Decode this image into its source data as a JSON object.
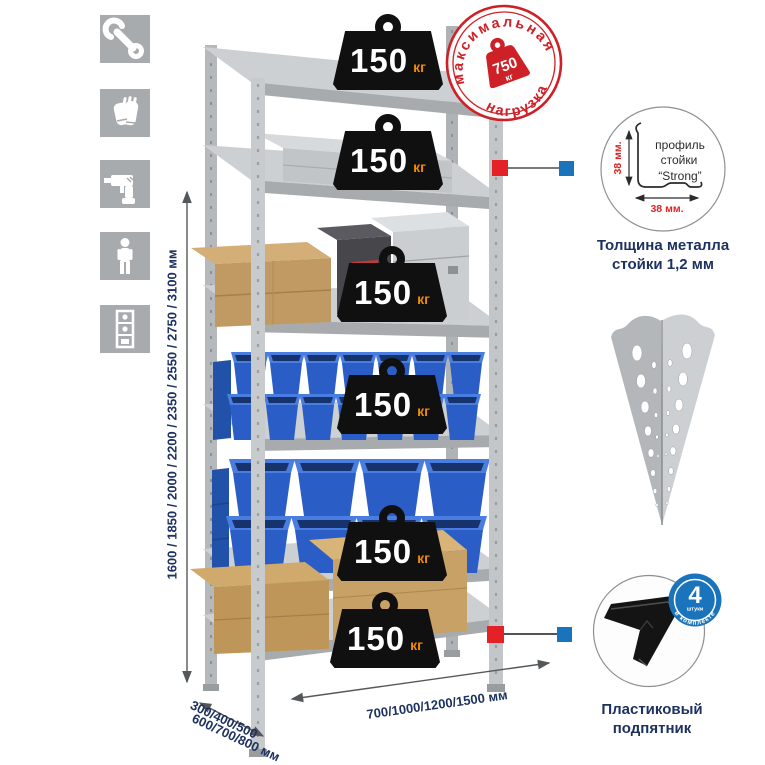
{
  "stamp": {
    "arc_top": "максимальная",
    "arc_bottom": "нагрузка",
    "weight_value": "750",
    "weight_unit": "кг"
  },
  "badge": {
    "value": "150",
    "unit": "кг",
    "count": 6
  },
  "dimensions": {
    "height": "1600 / 1850 / 2000 / 2200 / 2350 / 2550 / 2750 / 3100 мм",
    "depth_top": "300/400/500",
    "depth_bottom": "600/700/800 мм",
    "width": "700/1000/1200/1500 мм"
  },
  "profile_callout": {
    "dim_height": "38 мм.",
    "dim_width": "38 мм.",
    "label_l1": "профиль",
    "label_l2": "стойки",
    "label_l3": "“Strong”",
    "caption_l1": "Толщина металла",
    "caption_l2": "стойки 1,2 мм"
  },
  "foot_callout": {
    "caption_l1": "Пластиковый",
    "caption_l2": "подпятник",
    "badge_number": "4",
    "badge_small": "штуки",
    "badge_arc": "в комплекте"
  },
  "icons": {
    "names": [
      "wrench",
      "gloves",
      "drill",
      "person",
      "rack"
    ]
  },
  "colors": {
    "accent_red": "#d2232a",
    "accent_blue": "#1a74bc",
    "metal_gray": "#c8cbcd",
    "bin_blue": "#2a5ec6",
    "box_tan": "#c19a63",
    "navy_text": "#1d3260"
  }
}
